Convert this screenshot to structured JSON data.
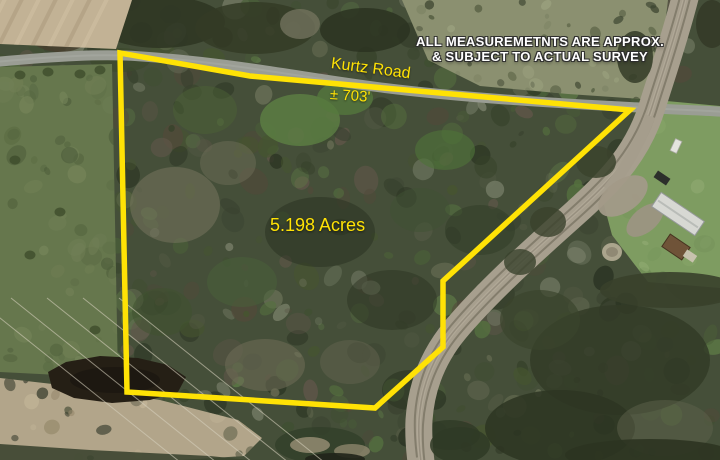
{
  "parcel": {
    "acreage_label": "5.198 Acres",
    "road_name": "Kurtz Road",
    "frontage_label": "± 703'",
    "boundary_points": "120,53 250,76 630,110 443,281 443,347 375,408 127,392"
  },
  "disclaimer": {
    "line1": "ALL MEASUREMETNTS ARE APPROX.",
    "line2": "& SUBJECT TO ACTUAL SURVEY"
  },
  "colors": {
    "boundary_yellow": "#FFE205",
    "label_yellow": "#FFE205",
    "disclaimer_white": "#FFFFFF"
  }
}
